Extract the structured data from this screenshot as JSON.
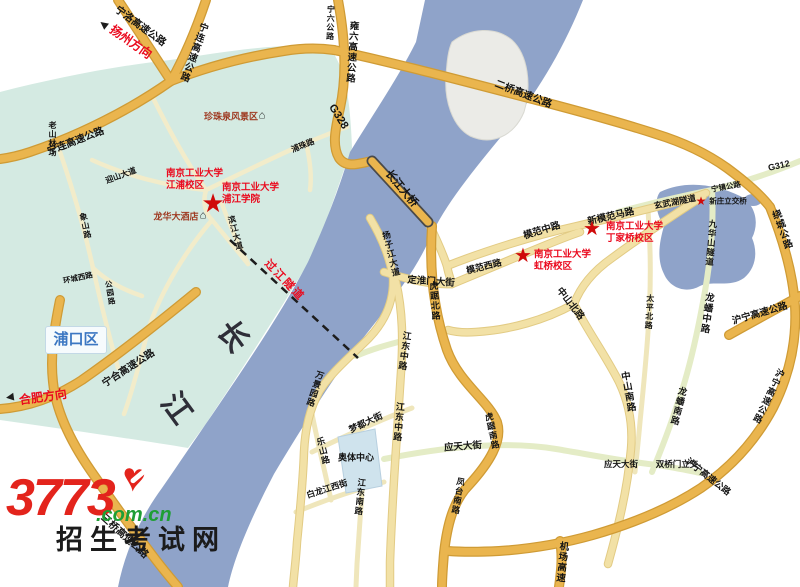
{
  "map": {
    "title": "南京工业大学校区位置地图",
    "colors": {
      "river": "#8fa3c9",
      "land_teal": "#d4eae2",
      "island": "#ebebe7",
      "highway": "#eab54e",
      "major_road": "#f2e1a6",
      "green_road": "#e4ecc6",
      "minor_road": "#f2ecca",
      "red_label": "#ea0a1e",
      "poi_label": "#9e3a22",
      "star": "#cf0a0a",
      "district_text": "#3b77c2"
    },
    "district_box": {
      "text": "浦口区"
    },
    "watermark": {
      "brand": "3773",
      "domain": ".com.cn",
      "site": "招生考试网",
      "heart_glyph": "♥",
      "brand_color": "#e3241c",
      "domain_color": "#1f9e35"
    },
    "multiline_labels": [
      {
        "id": "lbl-njtech-jiangpu-campus",
        "lines": [
          "南京工业大学",
          "江浦校区"
        ],
        "x": 166,
        "y": 168,
        "size": 9.5,
        "cls": "red"
      },
      {
        "id": "lbl-njtech-pujiang-college",
        "lines": [
          "南京工业大学",
          "浦江学院"
        ],
        "x": 222,
        "y": 182,
        "size": 9.5,
        "cls": "red"
      },
      {
        "id": "lbl-njtech-dingjiaqiao-campus",
        "lines": [
          "南京工业大学",
          "丁家桥校区"
        ],
        "x": 606,
        "y": 221,
        "size": 9.5,
        "cls": "red"
      },
      {
        "id": "lbl-njtech-hongqiao-campus",
        "lines": [
          "南京工业大学",
          "虹桥校区"
        ],
        "x": 534,
        "y": 249,
        "size": 9.5,
        "cls": "red"
      }
    ],
    "stars": [
      {
        "id": "star-jiangpu-campus",
        "x": 213,
        "y": 203,
        "size": 26
      },
      {
        "id": "star-dingjiaqiao-campus",
        "x": 592,
        "y": 229,
        "size": 20
      },
      {
        "id": "star-hongqiao-campus",
        "x": 523,
        "y": 256,
        "size": 20
      },
      {
        "id": "star-xinzhuang-interchange",
        "x": 701,
        "y": 201,
        "size": 12
      }
    ],
    "icons": [
      {
        "id": "scenic-spot-icon",
        "glyph": "⌂",
        "x": 262,
        "y": 116,
        "size": 11,
        "rot": 0,
        "cls": ""
      },
      {
        "id": "hotel-icon",
        "glyph": "⌂",
        "x": 203,
        "y": 216,
        "size": 11,
        "rot": 0,
        "cls": ""
      },
      {
        "id": "yangzhou-arrow-icon",
        "glyph": "►",
        "x": 103,
        "y": 25,
        "size": 13,
        "rot": -142,
        "cls": "red"
      },
      {
        "id": "hefei-arrow-icon",
        "glyph": "►",
        "x": 10,
        "y": 398,
        "size": 13,
        "rot": 172,
        "cls": "red"
      }
    ],
    "labels": [
      {
        "id": "lbl-ningluo-expwy",
        "text": "宁洛高速公路",
        "x": 140,
        "y": 27,
        "rot": 36,
        "size": 10
      },
      {
        "id": "lbl-yangzhou-direction",
        "text": "扬州方向",
        "x": 131,
        "y": 42,
        "rot": 35,
        "size": 12,
        "cls": "red"
      },
      {
        "id": "lbl-ninglian-expwy-n",
        "text": "宁连高速公路",
        "x": 193,
        "y": 52,
        "rot": 20,
        "size": 9.5,
        "vert": true
      },
      {
        "id": "lbl-ningliu-road",
        "text": "宁六公路",
        "x": 330,
        "y": 23,
        "rot": 2,
        "size": 8,
        "vert": true
      },
      {
        "id": "lbl-yongliu-expwy",
        "text": "雍六高速公路",
        "x": 351,
        "y": 52,
        "rot": 4,
        "size": 9.5,
        "vert": true
      },
      {
        "id": "lbl-g328",
        "text": "G328",
        "x": 338,
        "y": 117,
        "rot": 58,
        "size": 11
      },
      {
        "id": "lbl-erqiao-expwy",
        "text": "二桥高速公路",
        "x": 523,
        "y": 95,
        "rot": 21,
        "size": 10
      },
      {
        "id": "lbl-ninglian-expwy-w",
        "text": "宁连高速公路",
        "x": 76,
        "y": 142,
        "rot": -21,
        "size": 10
      },
      {
        "id": "lbl-laoshan-forest",
        "text": "老山林场",
        "x": 52,
        "y": 139,
        "rot": 0,
        "size": 8,
        "vert": true
      },
      {
        "id": "lbl-yingshan-avenue",
        "text": "迎山大道",
        "x": 121,
        "y": 176,
        "rot": -20,
        "size": 8
      },
      {
        "id": "lbl-puzhu-road",
        "text": "浦珠路",
        "x": 303,
        "y": 146,
        "rot": -22,
        "size": 8
      },
      {
        "id": "lbl-changjiang-bridge",
        "text": "长江大桥",
        "x": 401,
        "y": 189,
        "rot": 50,
        "size": 11
      },
      {
        "id": "lbl-g312",
        "text": "G312",
        "x": 779,
        "y": 166,
        "rot": -13,
        "size": 9
      },
      {
        "id": "lbl-ningzhen-road",
        "text": "宁镇公路",
        "x": 726,
        "y": 187,
        "rot": -10,
        "size": 7.5
      },
      {
        "id": "lbl-xuanwu-lake-tunnel",
        "text": "玄武湖隧道",
        "x": 675,
        "y": 202,
        "rot": -11,
        "size": 8.5
      },
      {
        "id": "lbl-xinzhuang-interchange",
        "text": "新庄立交桥",
        "x": 728,
        "y": 201,
        "rot": 0,
        "size": 7.5
      },
      {
        "id": "lbl-xinmofan-road",
        "text": "新模范马路",
        "x": 611,
        "y": 217,
        "rot": -13,
        "size": 9.5
      },
      {
        "id": "lbl-mofan-mid-road",
        "text": "模范中路",
        "x": 542,
        "y": 231,
        "rot": -17,
        "size": 9.5
      },
      {
        "id": "lbl-mofan-west-road",
        "text": "模范西路",
        "x": 484,
        "y": 267,
        "rot": -14,
        "size": 9
      },
      {
        "id": "lbl-dinghuaimen-street",
        "text": "定淮门大街",
        "x": 431,
        "y": 282,
        "rot": 4,
        "size": 9.5
      },
      {
        "id": "lbl-hujubei-road",
        "text": "虎踞北路",
        "x": 434,
        "y": 301,
        "rot": -4,
        "size": 9,
        "vert": true
      },
      {
        "id": "lbl-jiuhuashan-tunnel",
        "text": "九华山隧道",
        "x": 711,
        "y": 243,
        "rot": 5,
        "size": 8.5,
        "vert": true
      },
      {
        "id": "lbl-raocheng-road",
        "text": "绕城公路",
        "x": 781,
        "y": 230,
        "rot": -20,
        "size": 9.5,
        "vert": true
      },
      {
        "id": "lbl-huning-expwy-e",
        "text": "沪宁高速公路",
        "x": 760,
        "y": 314,
        "rot": -16,
        "size": 9.5
      },
      {
        "id": "lbl-huning-expwy-s",
        "text": "沪宁高速公路",
        "x": 768,
        "y": 396,
        "rot": 26,
        "size": 9,
        "vert": true
      },
      {
        "id": "lbl-zhongshanbei-road",
        "text": "中山北路",
        "x": 570,
        "y": 304,
        "rot": 52,
        "size": 9.5
      },
      {
        "id": "lbl-zhongshannan-road",
        "text": "中山南路",
        "x": 627,
        "y": 392,
        "rot": -10,
        "size": 9.5,
        "vert": true
      },
      {
        "id": "lbl-longpanzhong-road",
        "text": "龙蟠中路",
        "x": 706,
        "y": 313,
        "rot": 8,
        "size": 9.5,
        "vert": true
      },
      {
        "id": "lbl-longpannan-road",
        "text": "龙蟠南路",
        "x": 678,
        "y": 406,
        "rot": 14,
        "size": 9,
        "vert": true
      },
      {
        "id": "lbl-taipingbei-road",
        "text": "太平北路",
        "x": 649,
        "y": 312,
        "rot": 3,
        "size": 8,
        "vert": true
      },
      {
        "id": "lbl-yingtian-street-w",
        "text": "应天大街",
        "x": 463,
        "y": 447,
        "rot": -4,
        "size": 9.5
      },
      {
        "id": "lbl-yingtian-street-e",
        "text": "应天大街",
        "x": 621,
        "y": 464,
        "rot": 0,
        "size": 8.5
      },
      {
        "id": "lbl-shuangqiaomen-interchange",
        "text": "双桥门立交",
        "x": 677,
        "y": 464,
        "rot": 0,
        "size": 8.5
      },
      {
        "id": "lbl-huning-expwy-sw",
        "text": "沪宁高速公路",
        "x": 708,
        "y": 477,
        "rot": 38,
        "size": 9
      },
      {
        "id": "lbl-jichang-expwy",
        "text": "机场高速",
        "x": 561,
        "y": 562,
        "rot": 6,
        "size": 9.5,
        "vert": true
      },
      {
        "id": "lbl-fengtainan-road",
        "text": "凤台南路",
        "x": 458,
        "y": 496,
        "rot": 10,
        "size": 8.5,
        "vert": true
      },
      {
        "id": "lbl-hujunan-road",
        "text": "虎踞南路",
        "x": 492,
        "y": 431,
        "rot": -12,
        "size": 8.5,
        "vert": true
      },
      {
        "id": "lbl-jiangdongzhong-road-n",
        "text": "江东中路",
        "x": 404,
        "y": 351,
        "rot": 8,
        "size": 9,
        "vert": true
      },
      {
        "id": "lbl-jiangdongzhong-road-s",
        "text": "江东中路",
        "x": 398,
        "y": 422,
        "rot": 5,
        "size": 9,
        "vert": true
      },
      {
        "id": "lbl-yangzijiang-avenue",
        "text": "扬子江大道",
        "x": 391,
        "y": 254,
        "rot": -14,
        "size": 8.5,
        "vert": true
      },
      {
        "id": "lbl-wanjingyuan-road",
        "text": "万景园路",
        "x": 315,
        "y": 389,
        "rot": 18,
        "size": 8.5,
        "vert": true
      },
      {
        "id": "lbl-leshan-road",
        "text": "乐山路",
        "x": 323,
        "y": 451,
        "rot": -14,
        "size": 8.5,
        "vert": true
      },
      {
        "id": "lbl-mengdu-street",
        "text": "梦都大街",
        "x": 366,
        "y": 423,
        "rot": -25,
        "size": 9
      },
      {
        "id": "lbl-bailongjiangxi-street",
        "text": "白龙江西街",
        "x": 327,
        "y": 489,
        "rot": -18,
        "size": 8.5
      },
      {
        "id": "lbl-jiangdongnan-road",
        "text": "江东南路",
        "x": 360,
        "y": 497,
        "rot": 6,
        "size": 8.5,
        "vert": true
      },
      {
        "id": "lbl-aoti-center",
        "text": "奥体中心",
        "x": 356,
        "y": 458,
        "rot": 0,
        "size": 9
      },
      {
        "id": "lbl-guojiang-tunnel",
        "text": "过江隧道",
        "x": 284,
        "y": 281,
        "rot": 46,
        "size": 11,
        "cls": "red",
        "ls": 2
      },
      {
        "id": "lbl-ninghe-expwy",
        "text": "宁合高速公路",
        "x": 129,
        "y": 369,
        "rot": -33,
        "size": 10
      },
      {
        "id": "lbl-hefei-direction",
        "text": "合肥方向",
        "x": 43,
        "y": 397,
        "rot": -8,
        "size": 12,
        "cls": "red"
      },
      {
        "id": "lbl-sanqiao-expwy",
        "text": "三桥高速公路",
        "x": 124,
        "y": 537,
        "rot": 42,
        "size": 10
      },
      {
        "id": "lbl-binjiang-avenue",
        "text": "滨江大道",
        "x": 235,
        "y": 233,
        "rot": -15,
        "size": 8,
        "vert": true
      },
      {
        "id": "lbl-xiangshan-road",
        "text": "象山路",
        "x": 85,
        "y": 226,
        "rot": -12,
        "size": 8,
        "vert": true
      },
      {
        "id": "lbl-gongyuan-road",
        "text": "公园路",
        "x": 110,
        "y": 293,
        "rot": -10,
        "size": 7.5,
        "vert": true
      },
      {
        "id": "lbl-huanchengxi-road",
        "text": "环城西路",
        "x": 78,
        "y": 278,
        "rot": -12,
        "size": 7.5
      },
      {
        "id": "lbl-zhenzhuquan-scenic",
        "text": "珍珠泉风景区",
        "x": 231,
        "y": 117,
        "rot": 0,
        "size": 9,
        "cls": "poi"
      },
      {
        "id": "lbl-longhua-hotel",
        "text": "龙华大酒店",
        "x": 176,
        "y": 217,
        "rot": 0,
        "size": 9,
        "cls": "poi"
      },
      {
        "id": "lbl-yangtze-char-chang",
        "text": "长",
        "x": 232,
        "y": 337,
        "rot": 54,
        "size": 30,
        "cls": "river-char"
      },
      {
        "id": "lbl-yangtze-char-jiang",
        "text": "江",
        "x": 176,
        "y": 409,
        "rot": 54,
        "size": 30,
        "cls": "river-char"
      }
    ]
  }
}
